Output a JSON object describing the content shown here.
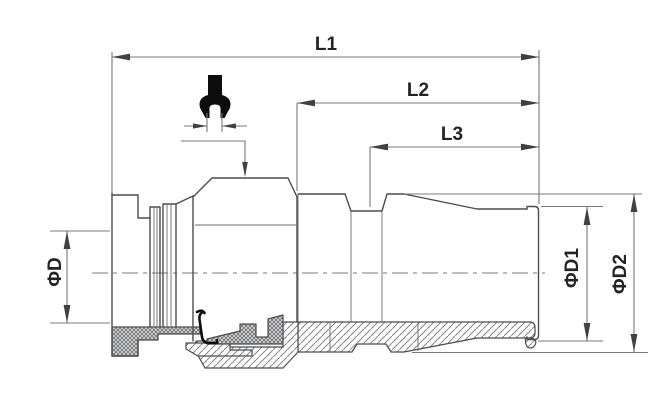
{
  "drawing": {
    "title": "push-in fitting half-section technical drawing",
    "labels": {
      "l1": "L1",
      "l2": "L2",
      "l3": "L3",
      "d": "ΦD",
      "d1": "ΦD1",
      "d2": "ΦD2"
    },
    "icons": {
      "wrench": "wrench-icon"
    },
    "colors": {
      "background": "#ffffff",
      "outline": "#4b4c4e",
      "dimension_lines": "#77787a",
      "arrowheads": "#3f4043",
      "text": "#232323",
      "wrench_icon": "#0d0d0d"
    }
  }
}
